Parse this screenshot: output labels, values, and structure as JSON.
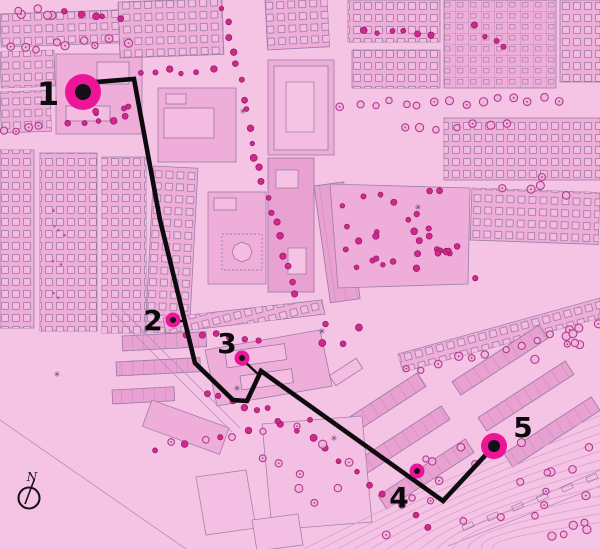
{
  "colors": {
    "background": "#f5c4e5",
    "block": "#efadd9",
    "block_dark": "#e9a1d2",
    "building": "#f4bce1",
    "outline": "#8b7096",
    "tree_ring": "#b03a8e",
    "tree_bright": "#d4268f",
    "contour": "#dba4cf",
    "route_black": "#0e0b0e",
    "marker_magenta": "#ec1598",
    "marker_center": "#141015",
    "label_black": "#0b090b"
  },
  "route": {
    "points": "83,83 134,79 160,220 195,363 233,400 247,401 261,371 443,501 494,446",
    "width": 4.6,
    "connector_2": "176,321 187,321",
    "connector_3": "244,361 258,374"
  },
  "stops": [
    {
      "label": "1",
      "x": 83,
      "y": 92,
      "r_outer": 18,
      "r_inner": 8,
      "label_x": 48,
      "label_y": 105
    },
    {
      "label": "2",
      "x": 173,
      "y": 320,
      "r_outer": 7.5,
      "r_inner": 3,
      "label_x": 153,
      "label_y": 330
    },
    {
      "label": "3",
      "x": 242,
      "y": 358,
      "r_outer": 7.5,
      "r_inner": 3,
      "label_x": 227,
      "label_y": 353
    },
    {
      "label": "4",
      "x": 417,
      "y": 471,
      "r_outer": 7.5,
      "r_inner": 3,
      "label_x": 399,
      "label_y": 507
    },
    {
      "label": "5",
      "x": 494,
      "y": 446,
      "r_outer": 13,
      "r_inner": 6,
      "label_x": 523,
      "label_y": 437
    }
  ],
  "compass": {
    "label": "N",
    "cx": 29,
    "cy": 498,
    "r": 10.5,
    "needle": "34.5,479 25,504",
    "label_x": 32,
    "label_y": 481
  }
}
